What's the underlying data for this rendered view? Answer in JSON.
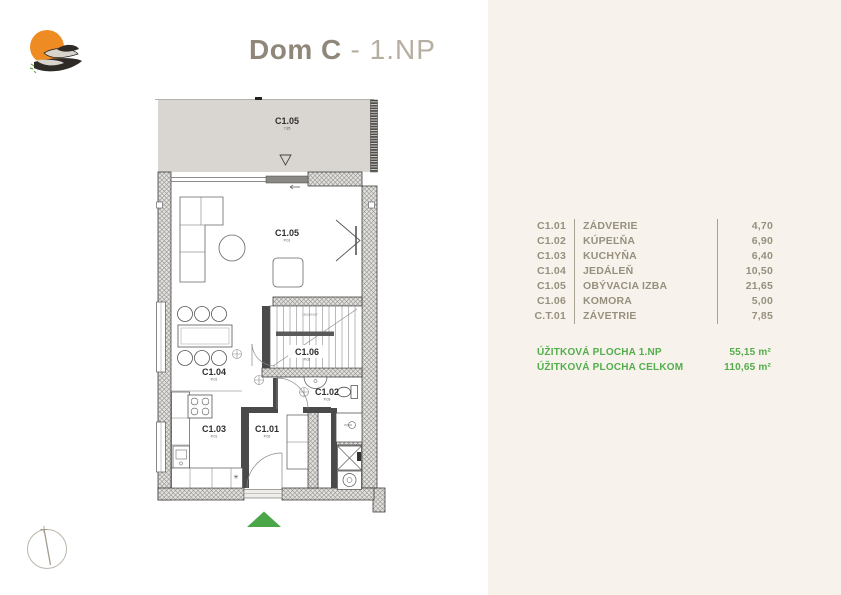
{
  "header": {
    "title_main": "Dom C",
    "title_suffix": " - 1.NP"
  },
  "logo": {
    "name": "swallow-sun-logo"
  },
  "plan": {
    "terrace": {
      "code": "C1.05",
      "sub": "7,85"
    },
    "rooms": {
      "living": {
        "code": "C1.05",
        "sub": "P.01"
      },
      "dining": {
        "code": "C1.04",
        "sub": "P.01"
      },
      "stairs": {
        "code": "C1.06",
        "sub": "P.02"
      },
      "bath": {
        "code": "C1.02",
        "sub": "P.03"
      },
      "kitchen": {
        "code": "C1.03",
        "sub": "P.01"
      },
      "entry": {
        "code": "C1.01",
        "sub": "P.02"
      }
    },
    "notes": {
      "stair_note": "18x250/167",
      "kitchen_mark": "✳"
    }
  },
  "legend": {
    "rows": [
      {
        "code": "C1.01",
        "name": "ZÁDVERIE",
        "area": "4,70"
      },
      {
        "code": "C1.02",
        "name": "KÚPEĽŇA",
        "area": "6,90"
      },
      {
        "code": "C1.03",
        "name": "KUCHYŇA",
        "area": "6,40"
      },
      {
        "code": "C1.04",
        "name": "JEDÁLEŇ",
        "area": "10,50"
      },
      {
        "code": "C1.05",
        "name": "OBÝVACIA IZBA",
        "area": "21,65"
      },
      {
        "code": "C1.06",
        "name": "KOMORA",
        "area": "5,00"
      },
      {
        "code": "C.T.01",
        "name": "ZÁVETRIE",
        "area": "7,85"
      }
    ],
    "summary": [
      {
        "label": "ÚŽITKOVÁ PLOCHA 1.NP",
        "value": "55,15 m²"
      },
      {
        "label": "ÚŽITKOVÁ PLOCHA CELKOM",
        "value": "110,65 m²"
      }
    ]
  },
  "colors": {
    "accent_green": "#54ad4c",
    "taupe_text": "#97907e",
    "terrace_gray": "#d9d6d1",
    "logo_orange": "#ef8b23"
  }
}
